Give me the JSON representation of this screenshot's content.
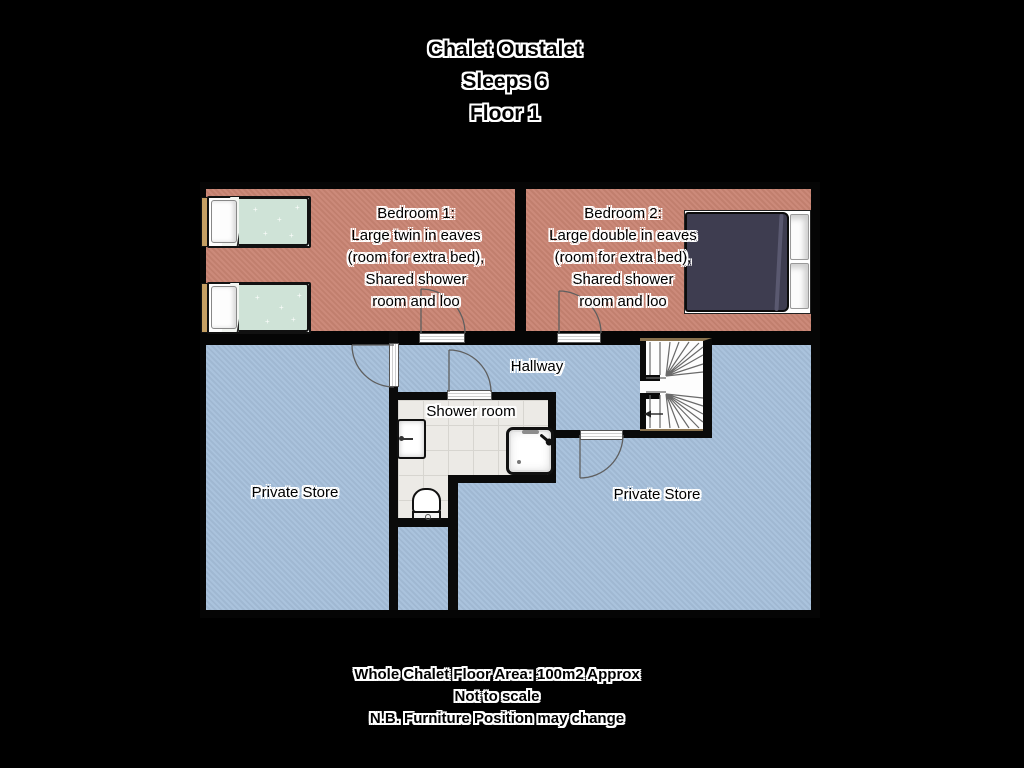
{
  "title": {
    "lines": [
      "Chalet Oustalet",
      "Sleeps 6",
      "Floor 1"
    ]
  },
  "rooms": {
    "bedroom1": {
      "name": "Bedroom 1:",
      "desc": [
        "Large twin in eaves",
        "(room for extra bed),",
        "Shared shower",
        "room and loo"
      ]
    },
    "bedroom2": {
      "name": "Bedroom 2:",
      "desc": [
        "Large double in eaves",
        "(room for extra bed),",
        "Shared shower",
        "room and loo"
      ]
    },
    "hallway": "Hallway",
    "shower_room": "Shower room",
    "private_store_left": "Private Store",
    "private_store_right": "Private Store"
  },
  "footer": {
    "lines": [
      "Whole Chalet Floor Area: 100m2 Approx",
      "Not to scale",
      "N.B. Furniture Position may change"
    ]
  },
  "colors": {
    "background": "#000000",
    "bedroom_floor": "#c98473",
    "store_floor": "#a6c0db",
    "shower_tile": "#eceae6",
    "wall": "#0a0a0a",
    "twin_duvet": "#cfe3d7",
    "double_duvet": "#3e3d50",
    "headboard": "#c59f63",
    "stair_trim": "#8a734f",
    "label_text": "#000000",
    "label_outline": "#ffffff"
  }
}
